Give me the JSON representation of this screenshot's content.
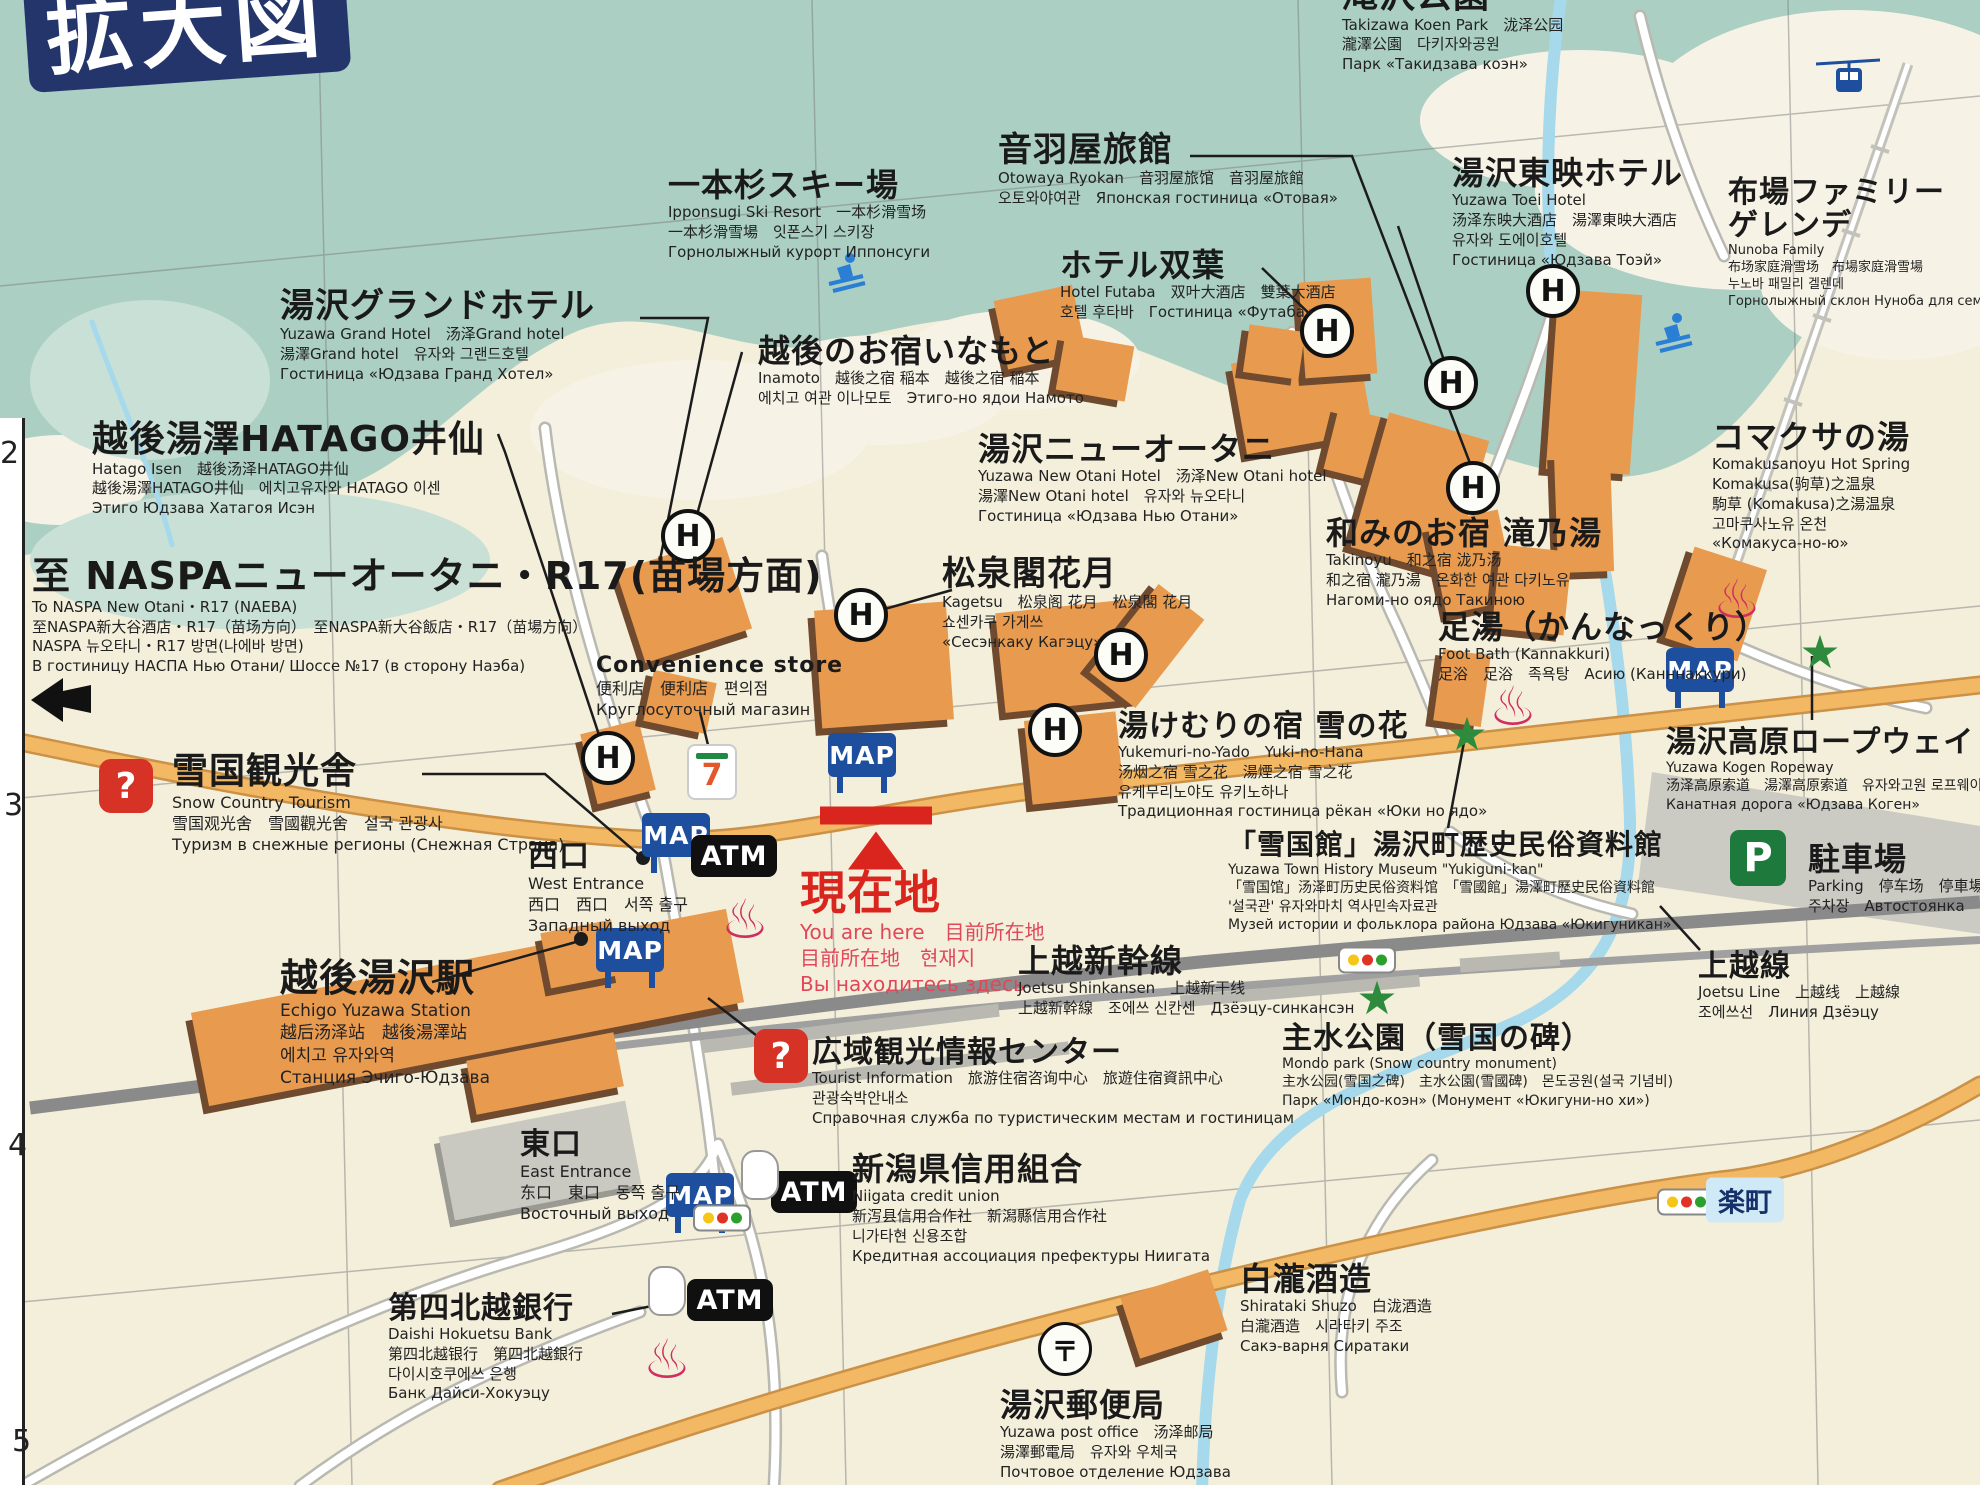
{
  "title": "拡大図",
  "colors": {
    "mountain_teal": "#abcfc3",
    "ground_cream": "#f3efdb",
    "building_orange": "#e89a4e",
    "building_shadow": "#6f4a2f",
    "road_orange": "#f3b863",
    "river_blue": "#a6d9ec",
    "map_badge_blue": "#1d4f9e",
    "marker_red": "#d9251d",
    "star_green": "#2e8b3d",
    "parking_green": "#1d7a3c",
    "question_red": "#d63226",
    "onsen_pink": "#cf2e5f"
  },
  "icon_text": {
    "hotel": "H",
    "map": "MAP",
    "atm": "ATM",
    "question": "?",
    "seven": "7",
    "onsen": "♨",
    "star": "★",
    "post": "〒",
    "parking": "P",
    "rakumachi": "楽町"
  },
  "grid_numbers": [
    {
      "t": "2",
      "x": 0,
      "y": 436
    },
    {
      "t": "3",
      "x": 4,
      "y": 788
    },
    {
      "t": "4",
      "x": 8,
      "y": 1128
    },
    {
      "t": "5",
      "x": 12,
      "y": 1424
    }
  ],
  "labels": [
    {
      "id": "takizawa-koen-park",
      "x": 1342,
      "y": -24,
      "hs": 36,
      "lines": [
        "滝沢公園",
        "Takizawa Koen Park　泷泽公园",
        "瀧澤公園　다키자와공원",
        "Парк «Такидзава коэн»"
      ]
    },
    {
      "id": "ipponsugi-ski-resort",
      "x": 668,
      "y": 168,
      "hs": 32,
      "lines": [
        "一本杉スキー場",
        "Ipponsugi Ski Resort　一本杉滑雪场",
        "一本杉滑雪場　잇폰스기 스키장",
        "Горнолыжный курорт Иппонсуги"
      ]
    },
    {
      "id": "otowaya-ryokan",
      "x": 998,
      "y": 132,
      "hs": 34,
      "lines": [
        "音羽屋旅館",
        "Otowaya Ryokan　音羽屋旅馆　音羽屋旅館",
        "오토와야여관　Японская гостиница «Отовая»"
      ]
    },
    {
      "id": "yuzawa-toei-hotel",
      "x": 1452,
      "y": 156,
      "hs": 32,
      "lines": [
        "湯沢東映ホテル",
        "Yuzawa Toei Hotel",
        "汤泽东映大酒店　湯澤東映大酒店",
        "유자와 도에이호텔",
        "Гостиница «Юдзава Тоэй»"
      ]
    },
    {
      "id": "nunoba-family-gelande",
      "x": 1728,
      "y": 176,
      "hs": 30,
      "hn": 2,
      "ss": 13,
      "lines": [
        "布場ファミリー",
        "ゲレンデ",
        "Nunoba Family",
        "布场家庭滑雪场　布場家庭滑雪場",
        "누노바 패밀리 겔렌데",
        "Горнолыжный склон Нуноба для семейного катания"
      ]
    },
    {
      "id": "yuzawa-grand-hotel",
      "x": 280,
      "y": 288,
      "hs": 34,
      "lines": [
        "湯沢グランドホテル",
        "Yuzawa Grand Hotel　汤泽Grand hotel",
        "湯澤Grand hotel　유자와 그랜드호텔",
        "Гостиница «Юдзава Гранд Хотел»"
      ]
    },
    {
      "id": "hotel-futaba",
      "x": 1060,
      "y": 248,
      "hs": 32,
      "lines": [
        "ホテル双葉",
        "Hotel Futaba　双叶大酒店　雙葉大酒店",
        "호텔 후타바　Гостиница «Футаба»"
      ]
    },
    {
      "id": "inamoto",
      "x": 758,
      "y": 334,
      "hs": 32,
      "lines": [
        "越後のお宿いなもと",
        "Inamoto　越後之宿 稲本　越後之宿 稲本",
        "에치고 여관 이나모토　Этиго-но ядои Намото"
      ]
    },
    {
      "id": "hatago-isen",
      "x": 92,
      "y": 420,
      "hs": 36,
      "lines": [
        "越後湯澤HATAGO井仙",
        "Hatago Isen　越後汤泽HATAGO井仙",
        "越後湯澤HATAGO井仙　에치고유자와 HATAGO 이센",
        "Этиго Юдзава Хатагоя Исэн"
      ]
    },
    {
      "id": "yuzawa-new-otani",
      "x": 978,
      "y": 432,
      "hs": 32,
      "lines": [
        "湯沢ニューオータニ",
        "Yuzawa New Otani Hotel　汤泽New Otani hotel",
        "湯澤New Otani hotel　유자와 뉴오타니",
        "Гостиница «Юдзава Нью Отани»"
      ]
    },
    {
      "id": "komakusanoyu-hot-spring",
      "x": 1712,
      "y": 420,
      "hs": 32,
      "lines": [
        "コマクサの湯",
        "Komakusanoyu Hot Spring",
        "Komakusa(驹草)之温泉",
        "駒草 (Komakusa)之湯温泉",
        "고마쿠사노유 온천",
        "«Комакуса-но-ю»"
      ]
    },
    {
      "id": "to-naspa-r17",
      "x": 32,
      "y": 556,
      "hs": 38,
      "lines": [
        "至 NASPAニューオータニ・R17(苗場方面)",
        "To NASPA New Otani・R17 (NAEBA)",
        "至NASPA新大谷酒店・R17（苗场方向）　至NASPA新大谷飯店・R17（苗場方向）",
        "NASPA 뉴오타니・R17 방면(나에바 방면)",
        "В гостиницу НАСПА Нью Отани/ Шоссе №17 (в сторону Наэба)"
      ]
    },
    {
      "id": "kagetsu",
      "x": 942,
      "y": 556,
      "hs": 34,
      "lines": [
        "松泉閣花月",
        "Kagetsu　松泉阁 花月　松泉閣 花月",
        "쇼센카쿠 가게쓰",
        "«Сесэнкаку Кагэцу»"
      ]
    },
    {
      "id": "takinoyu",
      "x": 1326,
      "y": 516,
      "hs": 32,
      "lines": [
        "和みのお宿 滝乃湯",
        "Takinoyu　和之宿 泷乃汤",
        "和之宿 瀧乃湯　온화한 여관 다키노유",
        "Нагоми-но оядо Такиною"
      ]
    },
    {
      "id": "foot-bath-kannakkuri",
      "x": 1438,
      "y": 610,
      "hs": 32,
      "lines": [
        "足湯（かんなっくり）",
        "Foot Bath (Kannakkuri)",
        "足浴　足浴　족욕탕　Асию (Канннаккури)"
      ]
    },
    {
      "id": "convenience-store",
      "x": 596,
      "y": 654,
      "hs": 22,
      "ss": 16,
      "lines": [
        "Convenience store",
        "便利店　便利店　편의점",
        "Круглосуточный магазин"
      ]
    },
    {
      "id": "snow-country-tourism",
      "x": 172,
      "y": 752,
      "hs": 36,
      "ss": 16,
      "lines": [
        "雪国観光舎",
        "Snow Country Tourism",
        "雪国观光舍　雪國觀光舍　설국 관광사",
        "Туризм в снежные регионы (Снежная Страна)"
      ]
    },
    {
      "id": "yukemuri-no-yado-yuki-no-hana",
      "x": 1118,
      "y": 710,
      "hs": 30,
      "lines": [
        "湯けむりの宿 雪の花",
        "Yukemuri-no-Yado　Yuki-no-Hana",
        "汤烟之宿 雪之花　湯煙之宿 雪之花",
        "유케무리노야도 유키노하나",
        "Традиционная гостиница рёкан «Юки но ядо»"
      ]
    },
    {
      "id": "yuzawa-kogen-ropeway",
      "x": 1666,
      "y": 726,
      "hs": 30,
      "ss": 14,
      "lines": [
        "湯沢高原ロープウェイ",
        "Yuzawa Kogen Ropeway",
        "汤泽高原索道　湯澤高原索道　유자와고원 로프웨이",
        "Канатная дорога «Юдзава Коген»"
      ]
    },
    {
      "id": "west-entrance",
      "x": 528,
      "y": 840,
      "hs": 30,
      "ss": 16,
      "lines": [
        "西口",
        "West Entrance",
        "西口　西口　서쪽 출구",
        "Западный выход"
      ]
    },
    {
      "id": "you-are-here",
      "x": 800,
      "y": 868,
      "hs": 46,
      "hc": "#d9251d",
      "sc": "#e0485a",
      "ss": 20,
      "lines": [
        "現在地",
        "You are here　目前所在地",
        "目前所在地　현재지",
        "Вы находитесь здесь"
      ]
    },
    {
      "id": "joetsu-shinkansen",
      "x": 1018,
      "y": 944,
      "hs": 32,
      "lines": [
        "上越新幹線",
        "Joetsu Shinkansen　上越新干线",
        "上越新幹線　조에쓰 신칸센　Дзёэцу-синкансэн"
      ]
    },
    {
      "id": "yukiguni-kan-museum",
      "x": 1228,
      "y": 830,
      "hs": 28,
      "ss": 14,
      "lines": [
        "「雪国館」湯沢町歴史民俗資料館",
        "Yuzawa Town History Museum \"Yukiguni-kan\"",
        "「雪国馆」汤泽町历史民俗资料馆　「雪國館」湯澤町歷史民俗資料館",
        "'설국관' 유자와마치 역사민속자료관",
        "Музей истории и фольклора района Юдзава «Юкигуникан»"
      ]
    },
    {
      "id": "joetsu-line",
      "x": 1698,
      "y": 950,
      "hs": 30,
      "lines": [
        "上越線",
        "Joetsu Line　上越线　上越線",
        "조에쓰선　Линия Дзёэцу"
      ]
    },
    {
      "id": "parking",
      "x": 1808,
      "y": 842,
      "hs": 32,
      "lines": [
        "駐車場",
        "Parking　停车场　停車場",
        "주차장　Автостоянка"
      ]
    },
    {
      "id": "echigo-yuzawa-station",
      "x": 280,
      "y": 958,
      "hs": 38,
      "ss": 17,
      "lines": [
        "越後湯沢駅",
        "Echigo Yuzawa Station",
        "越后汤泽站　越後湯澤站",
        "에치고 유자와역",
        "Станция Эчиго-Юдзава"
      ]
    },
    {
      "id": "mondo-park",
      "x": 1282,
      "y": 1022,
      "hs": 30,
      "ss": 14,
      "lines": [
        "主水公園（雪国の碑）",
        "Mondo park (Snow country monument)",
        "主水公园(雪国之碑)　主水公園(雪國碑)　몬도공원(설국 기념비)",
        "Парк «Мондо-коэн» (Монумент «Юкигуни-но хи»)"
      ]
    },
    {
      "id": "tourist-information",
      "x": 812,
      "y": 1036,
      "hs": 30,
      "lines": [
        "広域観光情報センター",
        "Tourist Information　旅游住宿咨询中心　旅遊住宿資訊中心",
        "관광숙박안내소",
        "Справочная служба по туристическим местам и гостиницам"
      ]
    },
    {
      "id": "east-entrance",
      "x": 520,
      "y": 1128,
      "hs": 30,
      "ss": 16,
      "lines": [
        "東口",
        "East Entrance",
        "东口　東口　동쪽 출구",
        "Восточный выход"
      ]
    },
    {
      "id": "niigata-credit-union",
      "x": 852,
      "y": 1152,
      "hs": 32,
      "lines": [
        "新潟県信用組合",
        "Niigata credit union",
        "新泻县信用合作社　新潟縣信用合作社",
        "니가타현 신용조합",
        "Кредитная ассоциация префектуры Ниигата"
      ]
    },
    {
      "id": "daishi-hokuetsu-bank",
      "x": 388,
      "y": 1292,
      "hs": 30,
      "lines": [
        "第四北越銀行",
        "Daishi Hokuetsu Bank",
        "第四北越银行　第四北越銀行",
        "다이시호쿠에쓰 은행",
        "Банк Дайси-Хокуэцу"
      ]
    },
    {
      "id": "shirataki-shuzo",
      "x": 1240,
      "y": 1262,
      "hs": 32,
      "lines": [
        "白瀧酒造",
        "Shirataki Shuzo　白泷酒造",
        "白瀧酒造　시라타키 주조",
        "Сакэ-варня Сиратаки"
      ]
    },
    {
      "id": "yuzawa-post-office",
      "x": 1000,
      "y": 1388,
      "hs": 32,
      "lines": [
        "湯沢郵便局",
        "Yuzawa post office　汤泽邮局",
        "湯澤郵電局　유자와 우체국",
        "Почтовое отделение Юдзава"
      ]
    }
  ],
  "buildings": [
    [
      628,
      552,
      112,
      96,
      -18
    ],
    [
      588,
      726,
      60,
      72,
      -14
    ],
    [
      648,
      676,
      64,
      52,
      12
    ],
    [
      818,
      606,
      132,
      118,
      -4
    ],
    [
      1000,
      606,
      136,
      100,
      -6
    ],
    [
      1000,
      292,
      80,
      70,
      -12
    ],
    [
      1060,
      340,
      70,
      56,
      10
    ],
    [
      1118,
      590,
      58,
      112,
      38
    ],
    [
      1028,
      716,
      92,
      84,
      -6
    ],
    [
      1238,
      352,
      128,
      92,
      -10
    ],
    [
      1330,
      416,
      84,
      64,
      14
    ],
    [
      1302,
      280,
      72,
      96,
      -4
    ],
    [
      1246,
      328,
      56,
      48,
      8
    ],
    [
      1368,
      424,
      104,
      140,
      16
    ],
    [
      1436,
      516,
      72,
      92,
      -12
    ],
    [
      1552,
      292,
      84,
      180,
      4
    ],
    [
      1556,
      452,
      56,
      120,
      -2
    ],
    [
      1496,
      548,
      72,
      84,
      6
    ],
    [
      1678,
      556,
      76,
      96,
      18
    ],
    [
      1438,
      652,
      48,
      72,
      8
    ],
    [
      195,
      960,
      545,
      95,
      -11
    ],
    [
      545,
      926,
      72,
      56,
      -11
    ],
    [
      470,
      1046,
      150,
      55,
      -11
    ],
    [
      1128,
      1282,
      92,
      64,
      -18
    ]
  ],
  "gray_buildings": [
    [
      445,
      1118,
      190,
      85,
      -11
    ]
  ],
  "platforms": [
    [
      700,
      1022,
      300,
      13,
      -7
    ],
    [
      730,
      1062,
      340,
      13,
      -7
    ],
    [
      1180,
      985,
      240,
      12,
      -5
    ],
    [
      1460,
      955,
      100,
      14,
      -4
    ]
  ],
  "icons": [
    {
      "t": "hotel",
      "x": 688,
      "y": 536
    },
    {
      "t": "hotel",
      "x": 608,
      "y": 758
    },
    {
      "t": "hotel",
      "x": 861,
      "y": 615
    },
    {
      "t": "hotel",
      "x": 1121,
      "y": 655
    },
    {
      "t": "hotel",
      "x": 1055,
      "y": 730
    },
    {
      "t": "hotel",
      "x": 1327,
      "y": 331
    },
    {
      "t": "hotel",
      "x": 1553,
      "y": 291
    },
    {
      "t": "hotel",
      "x": 1451,
      "y": 383
    },
    {
      "t": "hotel",
      "x": 1473,
      "y": 488
    },
    {
      "t": "map",
      "x": 676,
      "y": 835
    },
    {
      "t": "map",
      "x": 630,
      "y": 950
    },
    {
      "t": "map",
      "x": 862,
      "y": 755
    },
    {
      "t": "map",
      "x": 1700,
      "y": 670
    },
    {
      "t": "map",
      "x": 700,
      "y": 1195
    },
    {
      "t": "atm",
      "x": 734,
      "y": 856
    },
    {
      "t": "atm",
      "x": 814,
      "y": 1192
    },
    {
      "t": "atm",
      "x": 730,
      "y": 1300
    },
    {
      "t": "question",
      "x": 126,
      "y": 786
    },
    {
      "t": "question",
      "x": 781,
      "y": 1056
    },
    {
      "t": "seven",
      "x": 712,
      "y": 772
    },
    {
      "t": "onsen",
      "x": 745,
      "y": 920
    },
    {
      "t": "onsen",
      "x": 1513,
      "y": 707
    },
    {
      "t": "onsen",
      "x": 1737,
      "y": 600
    },
    {
      "t": "onsen",
      "x": 667,
      "y": 1360
    },
    {
      "t": "star",
      "x": 1467,
      "y": 734
    },
    {
      "t": "star",
      "x": 1377,
      "y": 998
    },
    {
      "t": "star",
      "x": 1820,
      "y": 652
    },
    {
      "t": "traffic",
      "x": 1367,
      "y": 960
    },
    {
      "t": "traffic",
      "x": 1686,
      "y": 1202
    },
    {
      "t": "traffic",
      "x": 722,
      "y": 1218
    },
    {
      "t": "post",
      "x": 1065,
      "y": 1349
    },
    {
      "t": "parking",
      "x": 1758,
      "y": 858
    },
    {
      "t": "skier",
      "x": 845,
      "y": 272
    },
    {
      "t": "skier",
      "x": 1672,
      "y": 332
    },
    {
      "t": "cable",
      "x": 1848,
      "y": 80
    },
    {
      "t": "arrow",
      "x": 62,
      "y": 700
    },
    {
      "t": "bankmark",
      "x": 760,
      "y": 1175
    },
    {
      "t": "bankmark",
      "x": 667,
      "y": 1291
    },
    {
      "t": "marker",
      "x": 876,
      "y": 838
    },
    {
      "t": "rakumachi",
      "x": 1745,
      "y": 1200
    }
  ]
}
